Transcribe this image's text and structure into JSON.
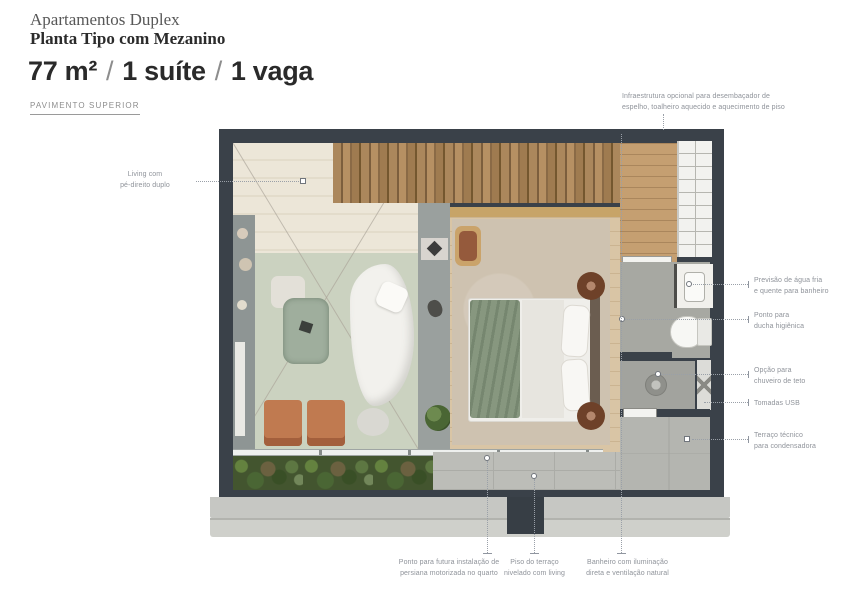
{
  "header": {
    "building": "Apartamentos Duplex",
    "plan_title": "Planta Tipo com Mezanino",
    "area": "77 m²",
    "separator": "/",
    "suite": "1 suíte",
    "parking": "1 vaga",
    "floor_label": "PAVIMENTO SUPERIOR"
  },
  "annotations": {
    "living": "Living com\npé-direito duplo",
    "infrastructure": "Infraestrutura opcional para desembaçador de\nespelho, toalheiro aquecido e aquecimento de piso",
    "water": "Previsão de água fria\ne quente para banheiro",
    "shower_point": "Ponto para\nducha higiênica",
    "ceiling_shower": "Opção para\nchuveiro de teto",
    "usb": "Tomadas USB",
    "tech_terrace": "Terraço técnico\npara condensadora",
    "blinds": "Ponto para futura instalação de\npersiana motorizada no quarto",
    "terrace_floor": "Piso do terraço\nnivelado com living",
    "bathroom": "Banheiro com iluminação\ndireta e ventilação natural"
  },
  "colors": {
    "wall": "#3a4149",
    "living_wood": "#ece6d8",
    "slat_wood": "#9c7a52",
    "hall_wood": "#c59f71",
    "rug_green": "#cbd2c0",
    "rug_beige": "#cec2b0",
    "bath_floor": "#a7a8a2",
    "terrace_paver": "#bcbdb8",
    "planter_green": "#43552f",
    "slab": "#c6c7c3",
    "annotation_text": "#8f939a"
  }
}
